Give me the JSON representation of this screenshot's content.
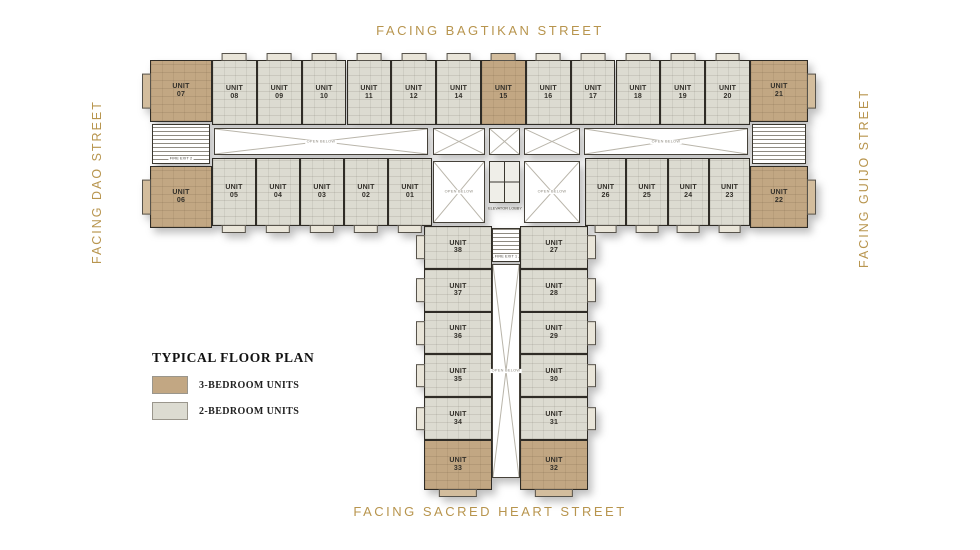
{
  "streets": {
    "top": "FACING BAGTIKAN STREET",
    "bottom": "FACING SACRED HEART STREET",
    "left": "FACING DAO STREET",
    "right": "FACING GUIJO STREET"
  },
  "legend": {
    "title": "TYPICAL FLOOR PLAN",
    "items": [
      {
        "label": "3-BEDROOM UNITS",
        "color": "#c2a783"
      },
      {
        "label": "2-BEDROOM UNITS",
        "color": "#dcdbd1"
      }
    ]
  },
  "colors": {
    "street_text": "#b8954e",
    "three_bedroom": "#c2a783",
    "two_bedroom": "#dcdbd1",
    "wall": "#2f2c26"
  },
  "unit_prefix": "UNIT",
  "plan": {
    "top_row": [
      {
        "no": "07",
        "type": "3br"
      },
      {
        "no": "08",
        "type": "2br"
      },
      {
        "no": "09",
        "type": "2br"
      },
      {
        "no": "10",
        "type": "2br"
      },
      {
        "no": "11",
        "type": "2br"
      },
      {
        "no": "12",
        "type": "2br"
      },
      {
        "no": "14",
        "type": "2br"
      },
      {
        "no": "15",
        "type": "3br"
      },
      {
        "no": "16",
        "type": "2br"
      },
      {
        "no": "17",
        "type": "2br"
      },
      {
        "no": "18",
        "type": "2br"
      },
      {
        "no": "19",
        "type": "2br"
      },
      {
        "no": "20",
        "type": "2br"
      },
      {
        "no": "21",
        "type": "3br"
      }
    ],
    "bottom_row_left": [
      {
        "no": "06",
        "type": "3br"
      },
      {
        "no": "05",
        "type": "2br"
      },
      {
        "no": "04",
        "type": "2br"
      },
      {
        "no": "03",
        "type": "2br"
      },
      {
        "no": "02",
        "type": "2br"
      },
      {
        "no": "01",
        "type": "2br"
      }
    ],
    "bottom_row_right": [
      {
        "no": "26",
        "type": "2br"
      },
      {
        "no": "25",
        "type": "2br"
      },
      {
        "no": "24",
        "type": "2br"
      },
      {
        "no": "23",
        "type": "2br"
      },
      {
        "no": "22",
        "type": "3br"
      }
    ],
    "stem_left": [
      {
        "no": "38",
        "type": "2br"
      },
      {
        "no": "37",
        "type": "2br"
      },
      {
        "no": "36",
        "type": "2br"
      },
      {
        "no": "35",
        "type": "2br"
      },
      {
        "no": "34",
        "type": "2br"
      },
      {
        "no": "33",
        "type": "3br"
      }
    ],
    "stem_right": [
      {
        "no": "27",
        "type": "2br"
      },
      {
        "no": "28",
        "type": "2br"
      },
      {
        "no": "29",
        "type": "2br"
      },
      {
        "no": "30",
        "type": "2br"
      },
      {
        "no": "31",
        "type": "2br"
      },
      {
        "no": "32",
        "type": "3br"
      }
    ],
    "labels": {
      "open_below": "OPEN BELOW",
      "elevator_lobby": "ELEVATOR LOBBY",
      "fire_exit_1": "FIRE EXIT 1",
      "fire_exit_2": "FIRE EXIT 2"
    }
  }
}
